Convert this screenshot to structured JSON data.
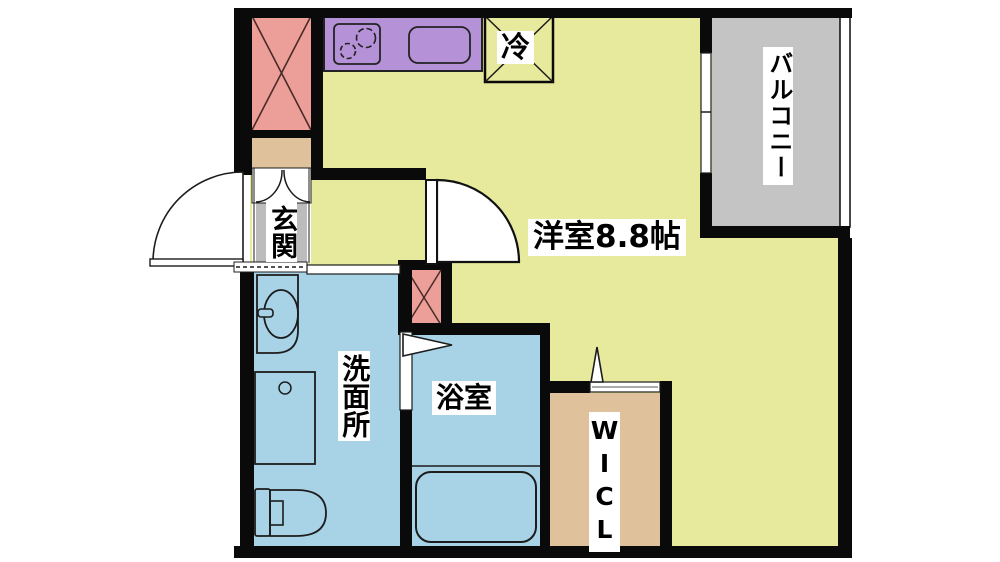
{
  "plan": {
    "type": "apartment-floor-plan",
    "rooms": {
      "main_room": {
        "label": "洋室8.8帖",
        "area_tatami": "8.8"
      },
      "balcony": {
        "label": "バルコニー"
      },
      "entrance": {
        "label": "玄関"
      },
      "washroom": {
        "label": "洗面所"
      },
      "bathroom": {
        "label": "浴室"
      },
      "walk_in_closet": {
        "label": "WICL"
      },
      "refrigerator": {
        "label": "冷"
      }
    },
    "colors": {
      "room_yellow": "#e7ea9c",
      "water_blue": "#a8d3e7",
      "balcony_gray": "#c4c4c4",
      "entrance_gray": "#bcbcbc",
      "closet_tan": "#dfc19b",
      "kitchen_purple": "#b591d7",
      "shaft_pink": "#ec9e98",
      "wall_black": "#0a0a0a",
      "fixture_line": "#1c1c1c"
    }
  }
}
